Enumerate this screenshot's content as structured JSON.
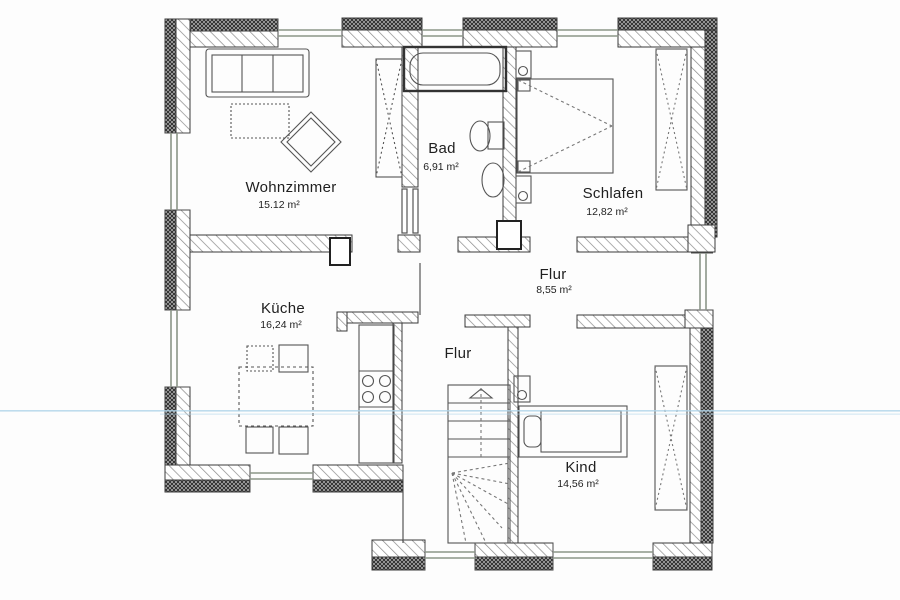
{
  "plan": {
    "type": "floor-plan",
    "language": "de",
    "rooms": [
      {
        "id": "wohnzimmer",
        "name": "Wohnzimmer",
        "area": "15.12 m²"
      },
      {
        "id": "bad",
        "name": "Bad",
        "area": "6,91 m²"
      },
      {
        "id": "schlafen",
        "name": "Schlafen",
        "area": "12,82 m²"
      },
      {
        "id": "flur",
        "name": "Flur",
        "area": "8,55 m²"
      },
      {
        "id": "kueche",
        "name": "Küche",
        "area": "16,24 m²"
      },
      {
        "id": "flur2",
        "name": "Flur"
      },
      {
        "id": "kind",
        "name": "Kind",
        "area": "14,56 m²"
      }
    ],
    "colors": {
      "paper": "#fdfdfd",
      "wall_line": "#3a3a3a",
      "hatch": "#8a8a8a",
      "dark_band": "#2f2f2f",
      "window": "#8b9688",
      "furniture": "#555555",
      "scan_artifact_blue": "#aed3e8"
    }
  }
}
